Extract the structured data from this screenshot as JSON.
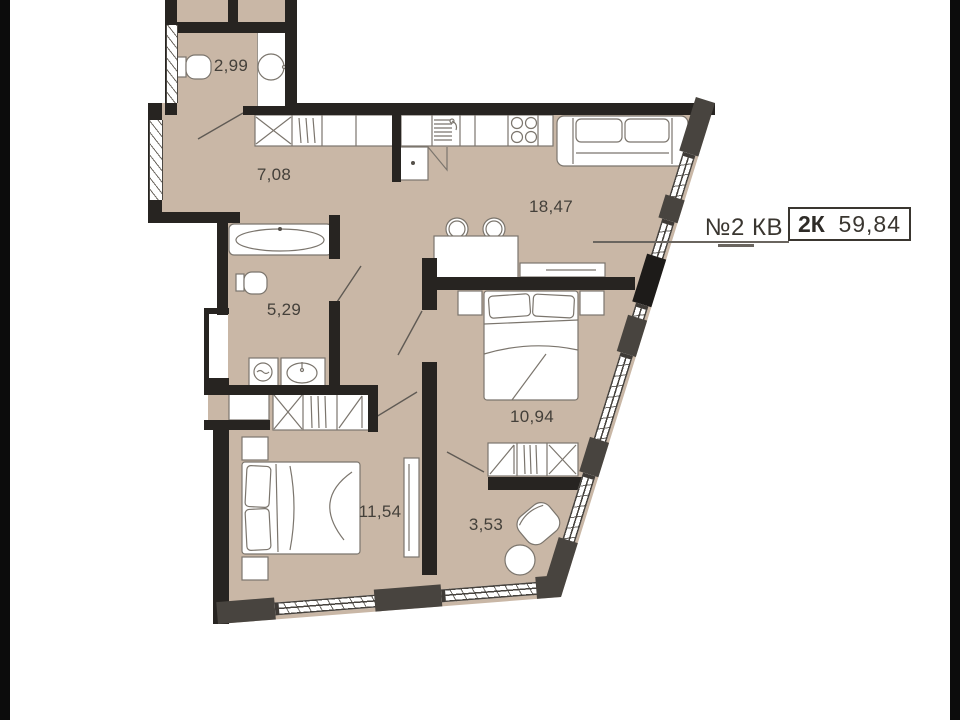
{
  "title": {
    "apartment_label": "№2 КВ",
    "layout_type": "2К",
    "total_area": "59,84"
  },
  "rooms": {
    "wc": {
      "area": "2,99"
    },
    "hallway": {
      "area": "7,08"
    },
    "living_kitchen": {
      "area": "18,47"
    },
    "bathroom": {
      "area": "5,29"
    },
    "bedroom_primary": {
      "area": "10,94"
    },
    "bedroom_secondary": {
      "area": "11,54"
    },
    "balcony": {
      "area": "3,53"
    }
  },
  "colors": {
    "floor": "#c9b7a6",
    "wall": "#272421",
    "pier": "#48443f",
    "stroke": "#7b756d",
    "text": "#44403a",
    "frame": "#0c0c0c"
  }
}
